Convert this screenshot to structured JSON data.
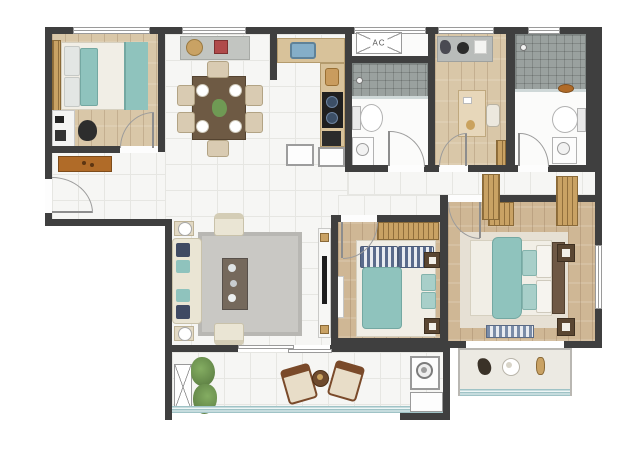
{
  "title": "four-bedroom apartment floor plan (top view render)",
  "labels": {
    "ac": "AC"
  },
  "colors": {
    "wall": "#3f3f3f",
    "tile_floor": "#f6f6f4",
    "wood_light": "#d9c7a8",
    "wood_mid": "#cfb795",
    "teal": "#8fc3bd",
    "cream": "#eae5d4",
    "rug": "#c9c8c4",
    "counter": "#d8c29a",
    "table_wood": "#6e5a44",
    "dresser_orange": "#b06b28",
    "gold": "#c9a264",
    "shower": "#9aa19f",
    "plant": "#6f9a54",
    "glass": "#9fc3c6",
    "stove": "#1f1f1f",
    "sink_blue": "#85aec8"
  },
  "rooms": [
    {
      "name": "bedroom-top-left",
      "furniture": [
        "double-bed-teal-bedding",
        "headboard",
        "desk",
        "office-chair",
        "shoe-dresser",
        "window"
      ]
    },
    {
      "name": "entry-hall",
      "furniture": [
        "entry-door"
      ]
    },
    {
      "name": "dining-area",
      "furniture": [
        "dining-table",
        "six-chairs",
        "plates",
        "centerpiece",
        "console-shelf",
        "basket",
        "red-box"
      ]
    },
    {
      "name": "kitchen",
      "furniture": [
        "sink",
        "cooktop-2-burner",
        "l-counter",
        "fridge",
        "base-cabinet"
      ]
    },
    {
      "name": "ac-platform-top",
      "furniture": [
        "ac-outdoor-unit"
      ]
    },
    {
      "name": "bathroom-1",
      "furniture": [
        "shower-area",
        "toilet",
        "vanity",
        "door"
      ]
    },
    {
      "name": "study-bedroom",
      "furniture": [
        "console-shelf",
        "desk",
        "chair",
        "bookshelf",
        "door"
      ]
    },
    {
      "name": "bathroom-2",
      "furniture": [
        "shower-area",
        "toilet",
        "vanity",
        "wood-mat",
        "door"
      ]
    },
    {
      "name": "hallway",
      "furniture": [
        "wardrobe-closet",
        "wardrobe-closet"
      ]
    },
    {
      "name": "living-room",
      "furniture": [
        "sofa",
        "two-armchairs",
        "coffee-table",
        "area-rug",
        "tv-console",
        "tv",
        "side-tables-with-lamps"
      ]
    },
    {
      "name": "bedroom-middle",
      "furniture": [
        "double-bed-teal-bedding",
        "striped-headboard",
        "two-nightstands",
        "white-dresser",
        "door"
      ]
    },
    {
      "name": "master-bedroom",
      "furniture": [
        "double-bed-teal-throw",
        "headboard",
        "two-nightstands",
        "two-wardrobes",
        "foot-bench",
        "rug",
        "bay-window-shelf",
        "window"
      ]
    },
    {
      "name": "balcony",
      "furniture": [
        "ac-platform",
        "plants",
        "two-lounge-chairs",
        "round-table",
        "sliding-door",
        "glass-railing"
      ]
    },
    {
      "name": "laundry-nook",
      "furniture": [
        "washing-machine",
        "cabinet"
      ]
    }
  ]
}
